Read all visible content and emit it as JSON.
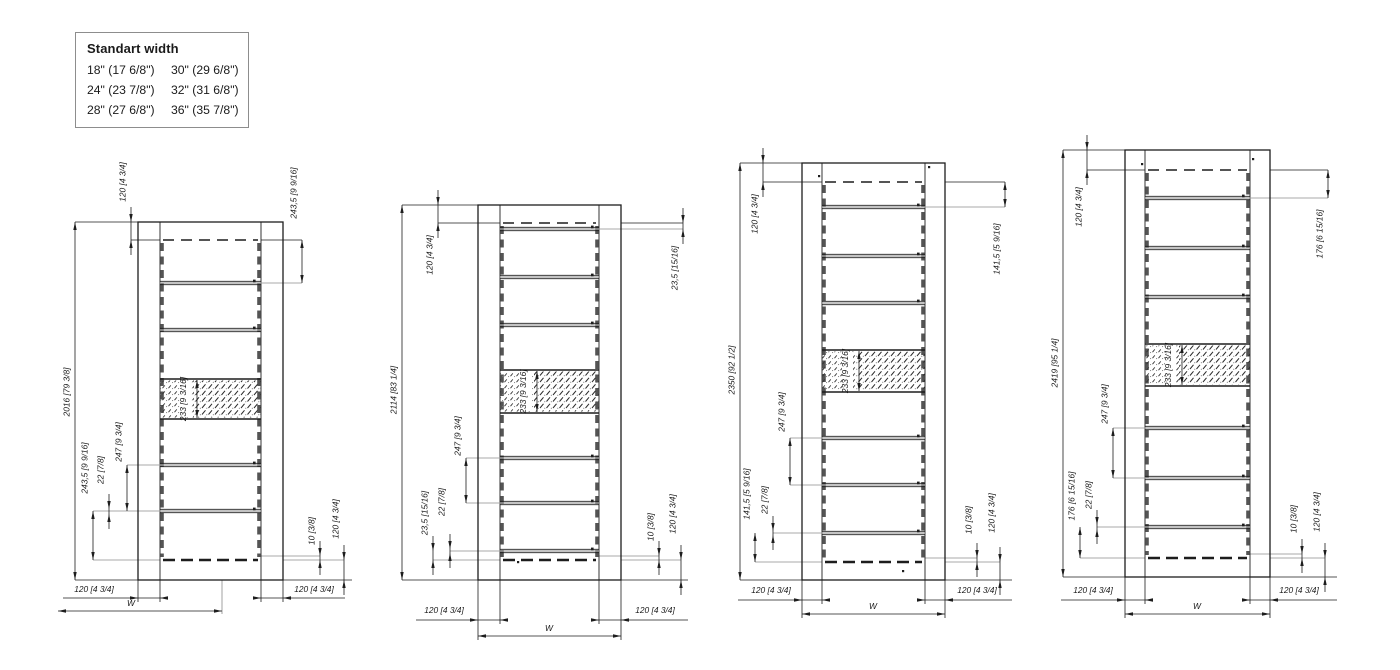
{
  "page": {
    "background": "#ffffff"
  },
  "colors": {
    "line": "#1d1d1d",
    "gray": "#a9a9a9",
    "rung_gray": "#9f9f9f",
    "dash_rail": "#545454",
    "hatch": "#2a2a2a",
    "legend_border": "#8d8d8d",
    "text": "#1a1a1a"
  },
  "legend": {
    "title": "Standart width",
    "rows": [
      [
        "18\" (17 6/8\")",
        "30\" (29 6/8\")"
      ],
      [
        "24\" (23 7/8\")",
        "32\" (31 6/8\")"
      ],
      [
        "28\" (27 6/8\")",
        "36\" (35 7/8\")"
      ]
    ]
  },
  "drawings": [
    {
      "name": "rack-2016",
      "overall_label": "2016 [79 3/8]",
      "frame": {
        "x": 138,
        "y": 222,
        "w": 145,
        "h": 358
      },
      "rail_w": 22,
      "dashed_top": 240,
      "dashed_bottom": 560,
      "rungs": [
        283,
        330,
        465,
        511
      ],
      "hatch": {
        "top": 379,
        "bottom": 419,
        "label": "233 [9 3/16]"
      },
      "vdims": [
        {
          "x": 75,
          "y1": 222,
          "y2": 580,
          "label": "2016 [79 3/8]",
          "ly": 392
        },
        {
          "x": 131,
          "y1": 222,
          "y2": 240,
          "label": "120 [4 3/4]",
          "ly": 182,
          "out": true
        },
        {
          "x": 302,
          "y1": 240,
          "y2": 283,
          "label": "243,5 [9 9/16]",
          "ly": 193
        },
        {
          "x": 93,
          "y1": 511,
          "y2": 560,
          "label": "243,5 [9 9/16]",
          "ly": 468
        },
        {
          "x": 109,
          "y1": 509,
          "y2": 514,
          "label": "22 [7/8]",
          "ly": 470,
          "out": true
        },
        {
          "x": 127,
          "y1": 465,
          "y2": 511,
          "label": "247 [9 3/4]",
          "ly": 442
        },
        {
          "x": 320,
          "y1": 556,
          "y2": 560,
          "label": "10 [3/8]",
          "ly": 531,
          "out": true
        },
        {
          "x": 344,
          "y1": 560,
          "y2": 580,
          "label": "120 [4 3/4]",
          "ly": 519,
          "out": true
        }
      ],
      "hdims": [
        {
          "y": 598,
          "x1": 63,
          "x2": 162,
          "a1": 138,
          "a2": 160,
          "label": "120 [4 3/4]",
          "lx": 94,
          "ly": 592
        },
        {
          "y": 598,
          "x1": 259,
          "x2": 345,
          "a1": 261,
          "a2": 283,
          "label": "120 [4 3/4]",
          "lx": 314,
          "ly": 592
        },
        {
          "y": 611,
          "x1": 58,
          "x2": 222,
          "label": "W",
          "lx": 131,
          "ly": 606
        }
      ],
      "leaders": [
        [
          75,
          222,
          138,
          222,
          "k"
        ],
        [
          75,
          580,
          138,
          580,
          "k"
        ],
        [
          131,
          240,
          160,
          240,
          "k"
        ],
        [
          261,
          240,
          302,
          240,
          "k"
        ],
        [
          160,
          283,
          302,
          283,
          "g"
        ],
        [
          127,
          465,
          259,
          465,
          "g"
        ],
        [
          93,
          511,
          259,
          511,
          "g"
        ],
        [
          93,
          560,
          160,
          560,
          "g"
        ],
        [
          261,
          556,
          320,
          556,
          "g"
        ],
        [
          283,
          560,
          344,
          560,
          "g"
        ],
        [
          283,
          580,
          352,
          580,
          "k"
        ],
        [
          138,
          580,
          138,
          602,
          "k"
        ],
        [
          160,
          580,
          160,
          602,
          "k"
        ],
        [
          261,
          580,
          261,
          602,
          "k"
        ],
        [
          283,
          580,
          283,
          602,
          "k"
        ],
        [
          222,
          580,
          222,
          614,
          "g"
        ]
      ],
      "dots": []
    },
    {
      "name": "rack-2114",
      "overall_label": "2114 [83 1/4]",
      "frame": {
        "x": 478,
        "y": 205,
        "w": 143,
        "h": 375
      },
      "rail_w": 22,
      "dashed_top": 223,
      "dashed_bottom": 560,
      "rungs": [
        229,
        277,
        325,
        458,
        503,
        551
      ],
      "hatch": {
        "top": 370,
        "bottom": 413,
        "label": "233 [9 3/16]"
      },
      "vdims": [
        {
          "x": 402,
          "y1": 205,
          "y2": 580,
          "label": "2114 [83 1/4]",
          "ly": 390
        },
        {
          "x": 438,
          "y1": 205,
          "y2": 223,
          "label": "120 [4 3/4]",
          "ly": 255,
          "out": true
        },
        {
          "x": 683,
          "y1": 223,
          "y2": 229,
          "label": "23,5 [15/16]",
          "ly": 268,
          "out": true
        },
        {
          "x": 433,
          "y1": 551,
          "y2": 560,
          "label": "23,5 [15/16]",
          "ly": 513,
          "out": true
        },
        {
          "x": 450,
          "y1": 549,
          "y2": 553,
          "label": "22 [7/8]",
          "ly": 502,
          "out": true
        },
        {
          "x": 466,
          "y1": 458,
          "y2": 503,
          "label": "247 [9 3/4]",
          "ly": 436
        },
        {
          "x": 659,
          "y1": 556,
          "y2": 560,
          "label": "10 [3/8]",
          "ly": 527,
          "out": true
        },
        {
          "x": 681,
          "y1": 560,
          "y2": 580,
          "label": "120 [4 3/4]",
          "ly": 514,
          "out": true
        }
      ],
      "hdims": [
        {
          "y": 620,
          "x1": 416,
          "x2": 502,
          "a1": 478,
          "a2": 500,
          "label": "120 [4 3/4]",
          "lx": 444,
          "ly": 613
        },
        {
          "y": 620,
          "x1": 597,
          "x2": 688,
          "a1": 599,
          "a2": 621,
          "label": "120 [4 3/4]",
          "lx": 655,
          "ly": 613
        },
        {
          "y": 636,
          "x1": 478,
          "x2": 621,
          "label": "W",
          "lx": 549,
          "ly": 631
        }
      ],
      "leaders": [
        [
          402,
          205,
          478,
          205,
          "k"
        ],
        [
          402,
          580,
          478,
          580,
          "k"
        ],
        [
          438,
          223,
          500,
          223,
          "k"
        ],
        [
          621,
          223,
          683,
          223,
          "k"
        ],
        [
          599,
          229,
          683,
          229,
          "g"
        ],
        [
          466,
          458,
          597,
          458,
          "g"
        ],
        [
          466,
          503,
          597,
          503,
          "g"
        ],
        [
          450,
          551,
          597,
          551,
          "g"
        ],
        [
          433,
          560,
          500,
          560,
          "g"
        ],
        [
          599,
          556,
          659,
          556,
          "g"
        ],
        [
          621,
          560,
          681,
          560,
          "g"
        ],
        [
          621,
          580,
          688,
          580,
          "k"
        ],
        [
          478,
          580,
          478,
          640,
          "k"
        ],
        [
          500,
          580,
          500,
          624,
          "k"
        ],
        [
          599,
          580,
          599,
          624,
          "k"
        ],
        [
          621,
          580,
          621,
          640,
          "k"
        ]
      ],
      "dots": [
        [
          517,
          561
        ]
      ]
    },
    {
      "name": "rack-2350",
      "overall_label": "2350 [92 1/2]",
      "frame": {
        "x": 802,
        "y": 163,
        "w": 143,
        "h": 417
      },
      "rail_w": 20,
      "dashed_top": 182,
      "dashed_bottom": 562,
      "rungs": [
        207,
        256,
        303,
        438,
        485,
        533
      ],
      "hatch": {
        "top": 350,
        "bottom": 392,
        "label": "233 [9 3/16]"
      },
      "vdims": [
        {
          "x": 740,
          "y1": 163,
          "y2": 580,
          "label": "2350 [92 1/2]",
          "ly": 370
        },
        {
          "x": 763,
          "y1": 163,
          "y2": 182,
          "label": "120 [4 3/4]",
          "ly": 214,
          "out": true
        },
        {
          "x": 1005,
          "y1": 182,
          "y2": 207,
          "label": "141,5 [5 9/16]",
          "ly": 249
        },
        {
          "x": 755,
          "y1": 533,
          "y2": 562,
          "label": "141,5 [5 9/16]",
          "ly": 494
        },
        {
          "x": 773,
          "y1": 531,
          "y2": 535,
          "label": "22 [7/8]",
          "ly": 500,
          "out": true
        },
        {
          "x": 790,
          "y1": 438,
          "y2": 485,
          "label": "247 [9 3/4]",
          "ly": 412
        },
        {
          "x": 977,
          "y1": 558,
          "y2": 562,
          "label": "10 [3/8]",
          "ly": 520,
          "out": true
        },
        {
          "x": 1000,
          "y1": 562,
          "y2": 580,
          "label": "120 [4 3/4]",
          "ly": 513,
          "out": true
        }
      ],
      "hdims": [
        {
          "y": 600,
          "x1": 738,
          "x2": 824,
          "a1": 802,
          "a2": 822,
          "label": "120 [4 3/4]",
          "lx": 771,
          "ly": 593
        },
        {
          "y": 600,
          "x1": 923,
          "x2": 1012,
          "a1": 925,
          "a2": 945,
          "label": "120 [4 3/4]",
          "lx": 977,
          "ly": 593
        },
        {
          "y": 614,
          "x1": 802,
          "x2": 945,
          "label": "W",
          "lx": 873,
          "ly": 609
        }
      ],
      "leaders": [
        [
          740,
          163,
          802,
          163,
          "k"
        ],
        [
          740,
          580,
          802,
          580,
          "k"
        ],
        [
          763,
          182,
          822,
          182,
          "k"
        ],
        [
          945,
          182,
          1005,
          182,
          "k"
        ],
        [
          822,
          207,
          1005,
          207,
          "g"
        ],
        [
          790,
          438,
          923,
          438,
          "g"
        ],
        [
          790,
          485,
          923,
          485,
          "g"
        ],
        [
          773,
          533,
          923,
          533,
          "g"
        ],
        [
          755,
          562,
          822,
          562,
          "g"
        ],
        [
          925,
          558,
          977,
          558,
          "g"
        ],
        [
          945,
          562,
          1000,
          562,
          "g"
        ],
        [
          945,
          580,
          1012,
          580,
          "k"
        ],
        [
          802,
          580,
          802,
          618,
          "k"
        ],
        [
          822,
          580,
          822,
          604,
          "k"
        ],
        [
          925,
          580,
          925,
          604,
          "k"
        ],
        [
          945,
          580,
          945,
          618,
          "k"
        ]
      ],
      "dots": [
        [
          818,
          175
        ],
        [
          928,
          166
        ],
        [
          902,
          570
        ]
      ]
    },
    {
      "name": "rack-2419",
      "overall_label": "2419 [95 1/4]",
      "frame": {
        "x": 1125,
        "y": 150,
        "w": 145,
        "h": 427
      },
      "rail_w": 20,
      "dashed_top": 170,
      "dashed_bottom": 558,
      "rungs": [
        198,
        248,
        297,
        428,
        478,
        527
      ],
      "hatch": {
        "top": 344,
        "bottom": 386,
        "label": "233 [9 3/16]"
      },
      "vdims": [
        {
          "x": 1063,
          "y1": 150,
          "y2": 577,
          "label": "2419 [95 1/4]",
          "ly": 363
        },
        {
          "x": 1087,
          "y1": 150,
          "y2": 170,
          "label": "120 [4 3/4]",
          "ly": 207,
          "out": true
        },
        {
          "x": 1328,
          "y1": 170,
          "y2": 198,
          "label": "176 [6 15/16]",
          "ly": 234
        },
        {
          "x": 1080,
          "y1": 527,
          "y2": 558,
          "label": "176 [6 15/16]",
          "ly": 496
        },
        {
          "x": 1097,
          "y1": 525,
          "y2": 529,
          "label": "22 [7/8]",
          "ly": 495,
          "out": true
        },
        {
          "x": 1113,
          "y1": 428,
          "y2": 478,
          "label": "247 [9 3/4]",
          "ly": 404
        },
        {
          "x": 1302,
          "y1": 554,
          "y2": 558,
          "label": "10 [3/8]",
          "ly": 519,
          "out": true
        },
        {
          "x": 1325,
          "y1": 558,
          "y2": 577,
          "label": "120 [4 3/4]",
          "ly": 512,
          "out": true
        }
      ],
      "hdims": [
        {
          "y": 600,
          "x1": 1061,
          "x2": 1147,
          "a1": 1125,
          "a2": 1145,
          "label": "120 [4 3/4]",
          "lx": 1093,
          "ly": 593
        },
        {
          "y": 600,
          "x1": 1248,
          "x2": 1337,
          "a1": 1250,
          "a2": 1270,
          "label": "120 [4 3/4]",
          "lx": 1299,
          "ly": 593
        },
        {
          "y": 614,
          "x1": 1125,
          "x2": 1270,
          "label": "W",
          "lx": 1197,
          "ly": 609
        }
      ],
      "leaders": [
        [
          1063,
          150,
          1125,
          150,
          "k"
        ],
        [
          1063,
          577,
          1125,
          577,
          "k"
        ],
        [
          1087,
          170,
          1145,
          170,
          "k"
        ],
        [
          1270,
          170,
          1328,
          170,
          "k"
        ],
        [
          1145,
          198,
          1328,
          198,
          "g"
        ],
        [
          1113,
          428,
          1248,
          428,
          "g"
        ],
        [
          1113,
          478,
          1248,
          478,
          "g"
        ],
        [
          1097,
          527,
          1248,
          527,
          "g"
        ],
        [
          1080,
          558,
          1145,
          558,
          "g"
        ],
        [
          1250,
          554,
          1302,
          554,
          "g"
        ],
        [
          1270,
          558,
          1325,
          558,
          "g"
        ],
        [
          1270,
          577,
          1337,
          577,
          "k"
        ],
        [
          1125,
          577,
          1125,
          618,
          "k"
        ],
        [
          1145,
          577,
          1145,
          604,
          "k"
        ],
        [
          1250,
          577,
          1250,
          604,
          "k"
        ],
        [
          1270,
          577,
          1270,
          618,
          "k"
        ]
      ],
      "dots": [
        [
          1141,
          163
        ],
        [
          1252,
          158
        ]
      ]
    }
  ]
}
